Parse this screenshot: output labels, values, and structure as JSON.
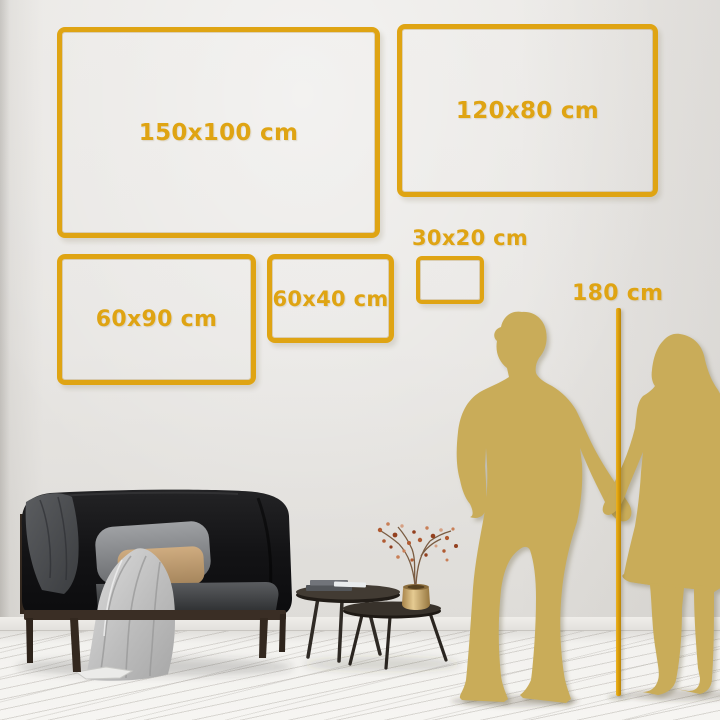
{
  "size_guide": {
    "sizes": [
      {
        "label": "150x100 cm"
      },
      {
        "label": "120x80 cm"
      },
      {
        "label": "60x90 cm"
      },
      {
        "label": "60x40 cm"
      },
      {
        "label": "30x20 cm"
      }
    ],
    "height_reference": {
      "label": "180 cm"
    }
  },
  "colors": {
    "accent_gold": "#DFA413",
    "silhouette_gold": "#C9AC59"
  },
  "scene_objects": [
    "man-silhouette",
    "woman-silhouette",
    "height-ruler",
    "sofa",
    "gray-blanket",
    "light-throw-blanket",
    "gray-pillow",
    "tan-pillow",
    "nesting-coffee-tables",
    "books",
    "gold-vase-with-dried-branches"
  ]
}
